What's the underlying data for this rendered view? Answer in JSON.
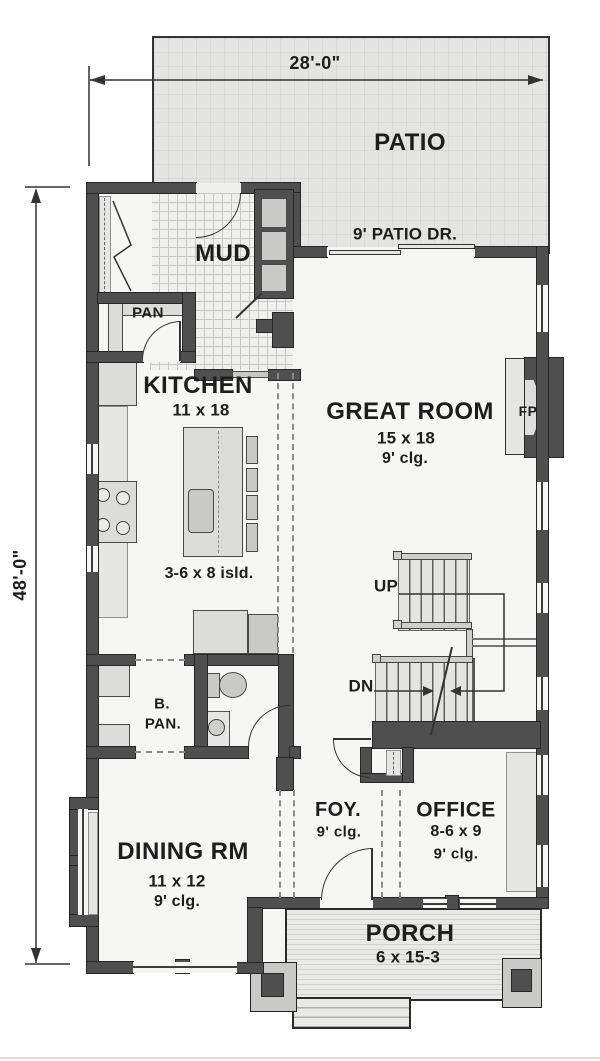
{
  "dimensions": {
    "width": "28'-0\"",
    "height": "48'-0\""
  },
  "rooms": {
    "patio": {
      "name": "PATIO"
    },
    "mud": {
      "name": "MUD"
    },
    "pantry": {
      "name": "PAN"
    },
    "kitchen": {
      "name": "KITCHEN",
      "size": "11 x 18",
      "island": "3-6 x 8 isld."
    },
    "great_room": {
      "name": "GREAT ROOM",
      "size": "15 x 18",
      "ceiling": "9' clg."
    },
    "butlers_pantry": {
      "name_line1": "B.",
      "name_line2": "PAN."
    },
    "dining": {
      "name": "DINING RM",
      "size": "11 x 12",
      "ceiling": "9' clg."
    },
    "foyer": {
      "name": "FOY.",
      "ceiling": "9' clg."
    },
    "office": {
      "name": "OFFICE",
      "size": "8-6 x 9",
      "ceiling": "9' clg."
    },
    "porch": {
      "name": "PORCH",
      "size": "6 x 15-3"
    }
  },
  "annotations": {
    "patio_door": "9' PATIO DR.",
    "fireplace": "FP",
    "stairs_up": "UP",
    "stairs_down": "DN"
  },
  "colors": {
    "wall": "#4f4f4f",
    "patio_fill": "#e4e4e2",
    "floor": "#f6f6f4",
    "counter": "#dcdcdb",
    "outline": "#333333",
    "text": "#1d1d1d"
  }
}
